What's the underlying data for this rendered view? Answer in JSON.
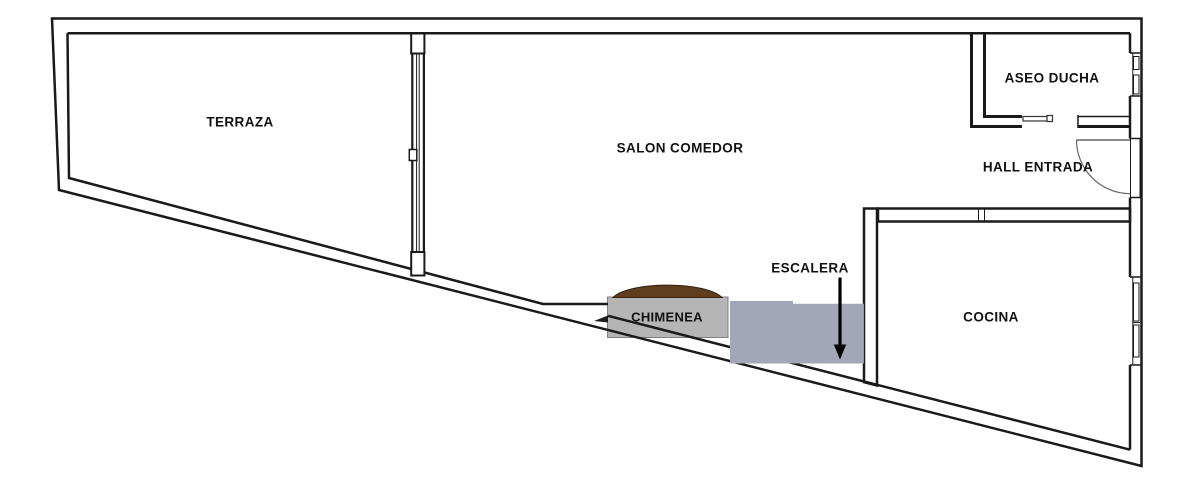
{
  "floor_plan": {
    "rooms": {
      "terraza": {
        "label": "TERRAZA"
      },
      "salon_comedor": {
        "label": "SALON COMEDOR"
      },
      "aseo_ducha": {
        "label": "ASEO DUCHA"
      },
      "hall_entrada": {
        "label": "HALL ENTRADA"
      },
      "cocina": {
        "label": "COCINA"
      }
    },
    "features": {
      "chimenea": {
        "label": "CHIMENEA"
      },
      "escalera": {
        "label": "ESCALERA"
      }
    },
    "colors": {
      "walls": "#1a1a1a",
      "background": "#ffffff",
      "fireplace_fill": "#b5b5b5",
      "fireplace_hood": "#5f3e20",
      "stairs_fill": "#a3a6b8",
      "arrow": "#000000"
    }
  }
}
